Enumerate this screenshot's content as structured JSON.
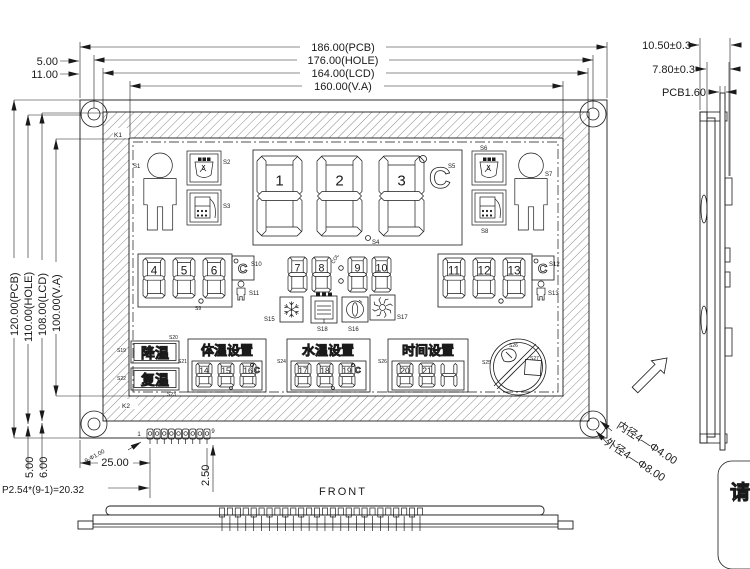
{
  "drawing": {
    "front_label": "FRONT",
    "corner_note": "请",
    "dims_top": [
      "186.00(PCB)",
      "176.00(HOLE)",
      "164.00(LCD)",
      "160.00(V.A)"
    ],
    "dims_top_left": [
      "5.00",
      "11.00"
    ],
    "dims_left": [
      "120.00(PCB)",
      "110.00(HOLE)",
      "108.00(LCD)",
      "100.00(V.A)"
    ],
    "dims_side": [
      "10.50±0.3",
      "7.80±0.3",
      "PCB1.60"
    ],
    "dims_bottom_left": [
      "5.00",
      "6.00"
    ],
    "dim_pin_span": "25.00",
    "dim_pin_pitch": "P2.54*(9-1)=20.32",
    "dim_pin_projection": "2.50",
    "dim_pin_hole": "9-Φ1.00",
    "pin_first": "1",
    "pin_last": "9",
    "hole_note_inner": "内径4—Φ4.00",
    "hole_note_outer": "外径4—Φ8.00"
  },
  "lcd": {
    "zone_top": "K1",
    "zone_bottom": "K2",
    "c_letter": "C",
    "colon_label": "COL",
    "labels": {
      "s1": "S1",
      "s2": "S2",
      "s3": "S3",
      "s4": "S4",
      "s5": "S5",
      "s6": "S6",
      "s7": "S7",
      "s8": "S8",
      "s9": "S9",
      "s10": "S10",
      "s11": "S11",
      "s12": "S12",
      "s13": "S13",
      "s15": "S15",
      "s16": "S16",
      "s17": "S17",
      "s18": "S18"
    },
    "main_digits": [
      "1",
      "2",
      "3"
    ],
    "temp_digits": [
      "4",
      "5",
      "6"
    ],
    "clock_digits": [
      "7",
      "8",
      "9",
      "10"
    ],
    "right_digits": [
      "11",
      "12",
      "13"
    ],
    "cool_button": {
      "text": "降温",
      "label_left": "S19",
      "label_top": "S20"
    },
    "rewarm_button": {
      "text": "复温",
      "label_left": "S22",
      "label_bottom": "S23"
    },
    "body_temp_group": {
      "title": "体温设置",
      "digits": [
        "14",
        "15",
        "16"
      ],
      "label": "S21"
    },
    "water_temp_group": {
      "title": "水温设置",
      "digits": [
        "17",
        "18",
        "19"
      ],
      "label": "S24"
    },
    "time_group": {
      "title": "时间设置",
      "digits": [
        "20",
        "21"
      ],
      "hour_glyph": "H",
      "label": "S26"
    },
    "prohibit_sign": {
      "label_left": "S25",
      "label_top": "S26",
      "label_square": "S27"
    }
  }
}
